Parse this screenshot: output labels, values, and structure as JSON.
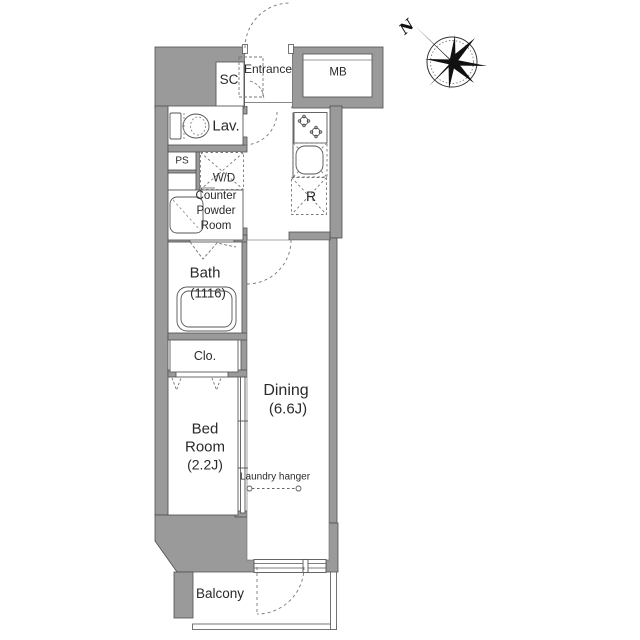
{
  "meta": {
    "type": "apartment floor plan"
  },
  "compass": {
    "north_label": "N"
  },
  "rooms": {
    "shoe_closet": {
      "label": "SC"
    },
    "entrance": {
      "label": "Entrance"
    },
    "meter_box": {
      "label": "MB"
    },
    "lavatory": {
      "label": "Lav."
    },
    "pipe_space": {
      "label": "PS"
    },
    "washer_dryer": {
      "label": "W/D"
    },
    "powder_room": {
      "line1": "Counter",
      "line2": "Powder",
      "line3": "Room"
    },
    "refrigerator": {
      "label": "R"
    },
    "bath": {
      "label": "Bath",
      "size": "(1116)"
    },
    "closet": {
      "label": "Clo."
    },
    "bedroom": {
      "line1": "Bed",
      "line2": "Room",
      "size": "(2.2J)"
    },
    "dining": {
      "label": "Dining",
      "size": "(6.6J)"
    },
    "laundry_hanger": {
      "label": "Laundry hanger"
    },
    "balcony": {
      "label": "Balcony"
    }
  },
  "colors": {
    "wall": "#9a9a9a",
    "wall_outline": "#4e4e4e",
    "line": "#555555",
    "dash": "#777777",
    "text": "#2a2a2a",
    "background": "#ffffff"
  }
}
